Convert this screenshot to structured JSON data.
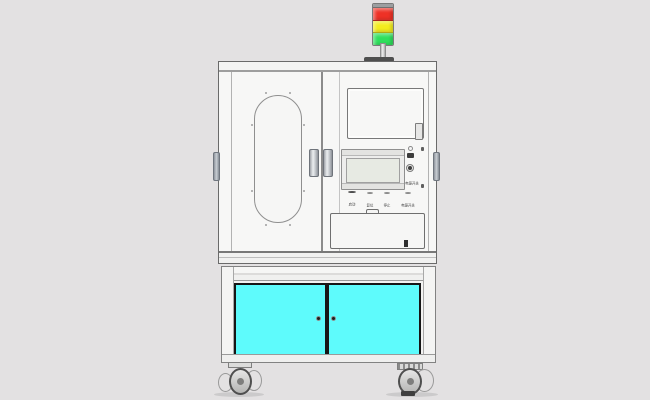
{
  "machine": {
    "description": "front view CAD render of an industrial test-equipment cabinet on casters",
    "palette": {
      "background": "#e3e1e2",
      "body": "#f7f7f6",
      "outline": "#6a6a6a"
    },
    "signal_tower": {
      "lights": [
        {
          "name": "red",
          "color": "#ee3126"
        },
        {
          "name": "yellow",
          "color": "#f3ec1d"
        },
        {
          "name": "green",
          "color": "#2fdf5c"
        }
      ]
    },
    "control_panel": {
      "buttons": [
        {
          "label": "启动",
          "color": "#1ed04d"
        },
        {
          "label": "复位",
          "color": "#eeeeec"
        },
        {
          "label": "停止",
          "color": "#eeeeec"
        },
        {
          "label": "电源开关",
          "color": "#eeeeec"
        }
      ],
      "key_switch_label": "电源开关"
    },
    "lower_cabinet": {
      "door_color": "#5efbfc"
    }
  }
}
